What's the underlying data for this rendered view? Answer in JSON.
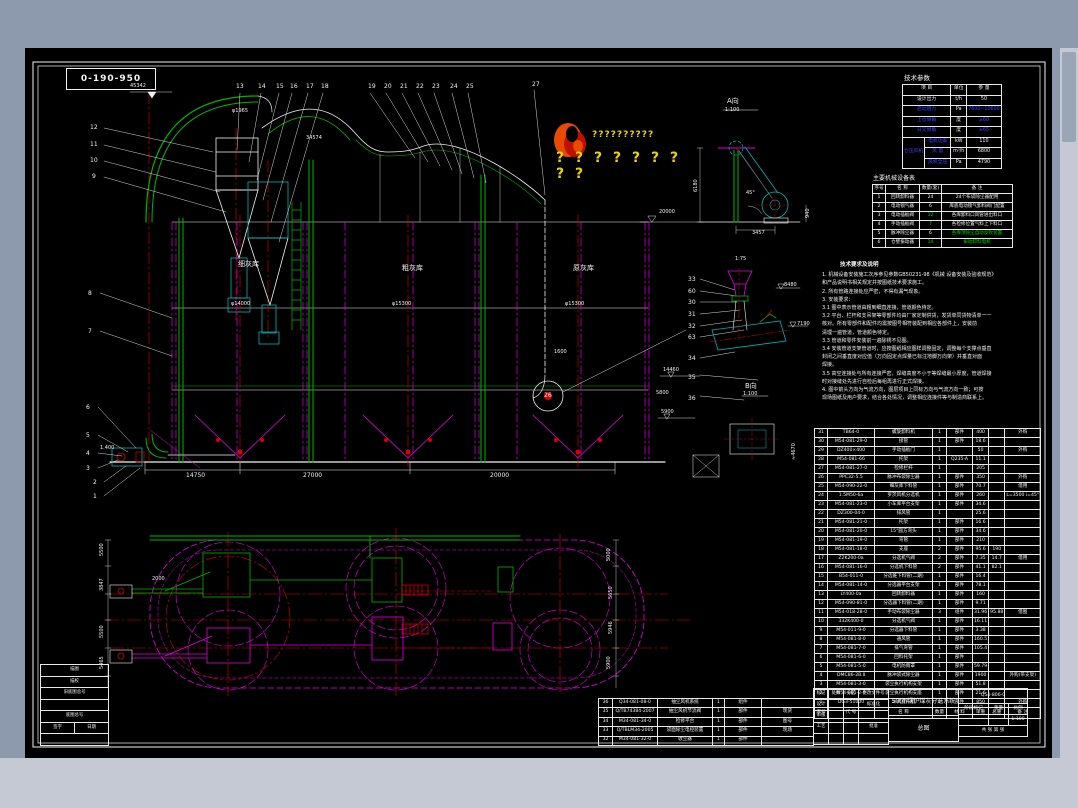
{
  "colors": {
    "window_top": "#8d9aad",
    "window_bottom": "#c4c9d3",
    "canvas": "#000000",
    "line": "#f2f2f2",
    "green": "#00b400",
    "magenta": "#e000e0",
    "red": "#dc0000",
    "cyan": "#00b4b4",
    "yellow": "#e8d400",
    "blue": "#3535ff"
  },
  "drawing_no_box": "0-190-950",
  "watermark": {
    "line1": "??????????",
    "line2": "···········",
    "line3": "? ? ? ? ? ? ? ? ?"
  },
  "tech_params": {
    "title": "技术参数",
    "headers": [
      "项  目",
      "单位",
      "参  量"
    ],
    "rows": [
      {
        "item": "设计出力",
        "unit": "t/h",
        "value": "50",
        "c": "w"
      },
      {
        "item": "启动阻力",
        "unit": "Pa",
        "value": "7600~10600",
        "c": "b"
      },
      {
        "item": "上仓倾角",
        "unit": "度",
        "value": "≥60",
        "c": "b"
      },
      {
        "item": "分叉倾角",
        "unit": "度",
        "value": "≥65",
        "c": "b"
      }
    ],
    "fan_group": {
      "label": "仓压风机",
      "rows": [
        {
          "item": "电机功率",
          "unit": "kW",
          "value": "110"
        },
        {
          "item": "风  量",
          "unit": "m³/h",
          "value": "6800"
        },
        {
          "item": "风机全压",
          "unit": "Pa",
          "value": "4790"
        }
      ]
    }
  },
  "equipment_table": {
    "title": "主要机械设备表",
    "headers": [
      "序号",
      "名  称",
      "数量(套)",
      "备    注"
    ],
    "rows": [
      [
        "1",
        "回转卸料器",
        "24",
        "24个布袋除尘器配用"
      ],
      [
        "2",
        "电动锁气器",
        "6",
        "库底电动锁气卸料阀门配置"
      ],
      [
        "3",
        "电动插板阀",
        {
          "t": "12",
          "c": "g"
        },
        "各库卸料口风管进出料口"
      ],
      [
        "4",
        "手动插板阀",
        {
          "t": "7",
          "c": "g"
        },
        "各检修位置气料上下料口"
      ],
      [
        "5",
        "脉冲除尘器",
        "6",
        {
          "t": "各库顶除尘自动反吹装置",
          "c": "g"
        }
      ],
      [
        "6",
        "仓壁振动器",
        {
          "t": "14",
          "c": "g"
        },
        {
          "t": "振动卸料电机",
          "c": "g"
        }
      ]
    ]
  },
  "notes": {
    "title": "技术要求及说明",
    "lines": [
      "1. 机械设备安装施工次序参见参数GB50231-98《机械 设备安装及验收规范》",
      "    和产品说明书相关规定并按图纸技术要求施工。",
      "2. 所有管路连接处应严密，不得有漏气现象。",
      "3. 安装要求：",
      "3.1 图中表示管道由粗到细直连接，管道颜色待定。",
      "3.2 平台、栏杆和支吊架等零部件均由厂家定制供货，发货单同货物清单一一",
      "    核对。所有零部件和配件均需按图号相符装配到相应各部件上，安装前",
      "    清理一遍管道，管道颜色待定。",
      "3.3 管道和零件安装前一遍除锈不见图。",
      "3.4 安装管道支架管道时，应按图纸相应图样调整固定，调整每个支撑点垂直",
      "    封闭之间垂直度对应值（万向固定点焊量已标注地脚万向架）并垂直对面",
      "    焊接。",
      "3.5 高空连接处与所有连接严密，焊缝高度不小于等焊缝最小厚度，管道焊接",
      "    时对接缝处先进行自检后每组再进行正式焊接。",
      "4. 图中箭头方向为气流方向，图层项目上同标方向与气流方向一致；可按",
      "    现场图纸及用户要求，结合各处情况，调整相应连接件等与制造商联系上。"
    ]
  },
  "bom_main": {
    "headers": [
      "序号",
      "代    号",
      "名    称",
      "数量",
      "材  料",
      "单重",
      "总重",
      "备 注"
    ],
    "rows": [
      [
        "31",
        "TB64-0",
        "螺旋卸料机",
        "1",
        "部件",
        "400",
        "",
        "外购"
      ],
      [
        "30",
        "M54-081-29-0",
        "接管",
        "1",
        "部件",
        "18.6",
        "",
        ""
      ],
      [
        "29",
        "DZ400×400",
        "手动插板门",
        "1",
        "",
        "50",
        "",
        "外购"
      ],
      [
        "28",
        "M54-081-66",
        "托架",
        "1",
        "Q235-A",
        "11.1",
        "",
        ""
      ],
      [
        "27",
        "M54-081-27-0",
        "检修栏杆",
        "1",
        "",
        "205",
        "",
        ""
      ],
      [
        "26",
        "PPC32-5.5",
        "脉冲布袋除尘器",
        "1",
        "部件",
        "350",
        "",
        "外购"
      ],
      [
        "25",
        "M54-090-22-0",
        "细灰库下料管",
        "1",
        "部件",
        "70.7",
        "",
        "借用"
      ],
      [
        "24",
        "1.5M50-6a",
        "罗茨风机分选机",
        "1",
        "部件",
        "260",
        "",
        "L=3500 i=45°"
      ],
      [
        "23",
        "M54-081-23-0",
        "小车库平台支架",
        "1",
        "部件",
        "34.6",
        "",
        ""
      ],
      [
        "22",
        "DZ300-04-0",
        "排风管",
        "1",
        "",
        "25.6",
        "",
        ""
      ],
      [
        "21",
        "M54-081-21-0",
        "托架",
        "1",
        "部件",
        "16.6",
        "",
        ""
      ],
      [
        "20",
        "M54-081-20-0",
        "15°圆方弯头",
        "1",
        "部件",
        "34.6",
        "",
        ""
      ],
      [
        "19",
        "M54-081-19-0",
        "弯管",
        "1",
        "部件",
        "210",
        "",
        ""
      ],
      [
        "18",
        "M54-081-18-0",
        "支座",
        "2",
        "部件",
        "95.6",
        "190",
        ""
      ],
      [
        "17",
        "Z2K200-0a",
        "分选机气阀",
        "2",
        "部件",
        "7.35",
        "14.7",
        "借用"
      ],
      [
        "16",
        "M54-081-16-0",
        "分选机下料管",
        "2",
        "部件",
        "41.1",
        "82.1",
        ""
      ],
      [
        "15",
        "B54-011-0",
        "分选锥下料管(二期)",
        "1",
        "部件",
        "16.4",
        "",
        ""
      ],
      [
        "14",
        "M54-081-14-0",
        "分选器平台支架",
        "1",
        "部件",
        "78.1",
        "",
        ""
      ],
      [
        "13",
        "LY400-0a",
        "回转卸料器",
        "1",
        "部件",
        "160",
        "",
        ""
      ],
      [
        "12",
        "M54-090-81-0",
        "分选器下料管(二期)",
        "1",
        "部件",
        "9.71",
        "",
        ""
      ],
      [
        "11",
        "M54-018-28-0",
        "手动布袋除尘器",
        "3",
        "组件",
        "31.96",
        "95.88",
        "借图"
      ],
      [
        "10",
        "332K400-0",
        "分选机气阀",
        "1",
        "部件",
        "16.11",
        "",
        ""
      ],
      [
        "9",
        "M54-011-9-0",
        "分选器下料管",
        "1",
        "部件",
        "3.38",
        "",
        ""
      ],
      [
        "8",
        "M54-081-8-0",
        "通风管",
        "1",
        "部件",
        "160.5",
        "",
        ""
      ],
      [
        "7",
        "M54-081-7-0",
        "排气弯管",
        "1",
        "部件",
        "105.4",
        "",
        ""
      ],
      [
        "6",
        "M54-081-6-0",
        "回料托架",
        "1",
        "部件",
        "",
        "",
        ""
      ],
      [
        "5",
        "M54-081-5-0",
        "电机防雨罩",
        "1",
        "部件",
        "59.79",
        "",
        ""
      ],
      [
        "4",
        "DMC86-2B.Ⅱ",
        "脉冲袋式除尘器",
        "1",
        "部件",
        "1900",
        "",
        "外购(带支架)"
      ],
      [
        "3",
        "M54-081-3-0",
        "袋尘执行机构支架",
        "1",
        "部件",
        "51.8",
        "",
        ""
      ],
      [
        "2",
        "M54-081-2-0",
        "袋尘执行机构支座",
        "1",
        "部件",
        "21.6",
        "",
        ""
      ],
      [
        "1",
        "DG3-51000",
        "斗式提升机",
        "1",
        "部件",
        "850",
        "",
        "外购"
      ]
    ]
  },
  "bom_extra": {
    "rows": [
      [
        "36",
        "Q34-081-08-0",
        "抽尘风机系统",
        "1",
        "组件",
        ""
      ],
      [
        "35",
        "Q/TB74384-2007",
        "抽尘风机节流阀",
        "1",
        "部件",
        "现货"
      ],
      [
        "34",
        "M34-081-34-0",
        "检修平台",
        "1",
        "部件",
        "图号"
      ],
      [
        "33",
        "Q/TBLM34-2005",
        "袋面除尘电控装置",
        "1",
        "部件",
        "现场"
      ],
      [
        "32",
        "M34-081-32-0",
        "收尘器",
        "1",
        "部件",
        ""
      ]
    ]
  },
  "title_block": {
    "title": "50t/h锅炉煤灰分选系统",
    "subtitle": "总图",
    "drawing_number": "Q54-806-0",
    "scale": "1:100",
    "stage_label": "阶段标记",
    "weight_label": "重量",
    "scale_label": "比例",
    "sheet": "共  张  第  张",
    "left_rows": [
      [
        "标记",
        "处数",
        "分区",
        "更改文件号"
      ],
      [
        "设计",
        "",
        "",
        "标准化"
      ],
      [
        "审核",
        "",
        "",
        ""
      ],
      [
        "工艺",
        "",
        "",
        "批准"
      ],
      [
        "",
        "",
        "",
        ""
      ]
    ]
  },
  "archive_block": {
    "rows": [
      [
        "描图"
      ],
      [
        "描校"
      ],
      [
        "旧底图总号"
      ],
      [
        ""
      ],
      [
        "底图总号"
      ],
      [
        "签字",
        "日期"
      ],
      [
        ""
      ]
    ]
  },
  "silos": [
    "细灰库",
    "粗灰库",
    "原灰库"
  ],
  "labels": [
    {
      "t": "45342",
      "x": 130,
      "y": 84,
      "s": 5
    },
    {
      "t": "φ1965",
      "x": 232,
      "y": 109,
      "s": 5
    },
    {
      "t": "34574",
      "x": 306,
      "y": 136,
      "s": 5
    },
    {
      "t": "13",
      "x": 236,
      "y": 84
    },
    {
      "t": "14",
      "x": 258,
      "y": 84
    },
    {
      "t": "15",
      "x": 276,
      "y": 84
    },
    {
      "t": "16",
      "x": 290,
      "y": 84
    },
    {
      "t": "17",
      "x": 306,
      "y": 84
    },
    {
      "t": "18",
      "x": 321,
      "y": 84
    },
    {
      "t": "19",
      "x": 368,
      "y": 84
    },
    {
      "t": "20",
      "x": 384,
      "y": 84
    },
    {
      "t": "21",
      "x": 400,
      "y": 84
    },
    {
      "t": "22",
      "x": 416,
      "y": 84
    },
    {
      "t": "23",
      "x": 432,
      "y": 84
    },
    {
      "t": "24",
      "x": 450,
      "y": 84
    },
    {
      "t": "25",
      "x": 466,
      "y": 84
    },
    {
      "t": "27",
      "x": 532,
      "y": 82
    },
    {
      "t": "12",
      "x": 90,
      "y": 125
    },
    {
      "t": "11",
      "x": 90,
      "y": 142
    },
    {
      "t": "10",
      "x": 90,
      "y": 158
    },
    {
      "t": "9",
      "x": 92,
      "y": 174
    },
    {
      "t": "8",
      "x": 88,
      "y": 291
    },
    {
      "t": "7",
      "x": 88,
      "y": 329
    },
    {
      "t": "6",
      "x": 86,
      "y": 405
    },
    {
      "t": "5",
      "x": 86,
      "y": 433
    },
    {
      "t": "4",
      "x": 86,
      "y": 451
    },
    {
      "t": "3",
      "x": 86,
      "y": 466
    },
    {
      "t": "2",
      "x": 93,
      "y": 480
    },
    {
      "t": "1",
      "x": 93,
      "y": 494
    },
    {
      "t": "1.400",
      "x": 100,
      "y": 446,
      "s": 5
    },
    {
      "t": "细灰库",
      "x": 238,
      "y": 261,
      "s": 7
    },
    {
      "t": "粗灰库",
      "x": 402,
      "y": 265,
      "s": 7
    },
    {
      "t": "原灰库",
      "x": 573,
      "y": 265,
      "s": 7
    },
    {
      "t": "φ14000",
      "x": 231,
      "y": 302,
      "s": 5
    },
    {
      "t": "φ15300",
      "x": 392,
      "y": 302,
      "s": 5
    },
    {
      "t": "φ15300",
      "x": 565,
      "y": 302,
      "s": 5
    },
    {
      "t": "20000",
      "x": 659,
      "y": 210,
      "s": 5
    },
    {
      "t": "5800",
      "x": 656,
      "y": 391,
      "s": 5
    },
    {
      "t": "1600",
      "x": 554,
      "y": 350,
      "s": 5
    },
    {
      "t": "26",
      "x": 544,
      "y": 393,
      "s": 6
    },
    {
      "t": "14750",
      "x": 186,
      "y": 473
    },
    {
      "t": "27000",
      "x": 303,
      "y": 473
    },
    {
      "t": "20000",
      "x": 490,
      "y": 473
    },
    {
      "t": "A向",
      "x": 727,
      "y": 98,
      "s": 7
    },
    {
      "t": "1:100",
      "x": 725,
      "y": 108,
      "s": 5
    },
    {
      "t": "6180",
      "x": 694,
      "y": 192,
      "s": 5,
      "r": -90
    },
    {
      "t": "45°",
      "x": 746,
      "y": 191,
      "s": 5
    },
    {
      "t": "3457",
      "x": 752,
      "y": 231,
      "s": 5
    },
    {
      "t": "940",
      "x": 806,
      "y": 218,
      "s": 5,
      "r": -90
    },
    {
      "t": "1:75",
      "x": 735,
      "y": 257,
      "s": 5
    },
    {
      "t": "33",
      "x": 688,
      "y": 277
    },
    {
      "t": "60",
      "x": 688,
      "y": 289
    },
    {
      "t": "30",
      "x": 688,
      "y": 300
    },
    {
      "t": "31",
      "x": 688,
      "y": 312
    },
    {
      "t": "32",
      "x": 688,
      "y": 324
    },
    {
      "t": "63",
      "x": 688,
      "y": 335
    },
    {
      "t": "34",
      "x": 688,
      "y": 356
    },
    {
      "t": "35",
      "x": 688,
      "y": 375
    },
    {
      "t": "36",
      "x": 688,
      "y": 396
    },
    {
      "t": "8480",
      "x": 784,
      "y": 283,
      "s": 5
    },
    {
      "t": "7190",
      "x": 797,
      "y": 322,
      "s": 5
    },
    {
      "t": "14460",
      "x": 663,
      "y": 368,
      "s": 5
    },
    {
      "t": "5900",
      "x": 661,
      "y": 410,
      "s": 5
    },
    {
      "t": "B向",
      "x": 745,
      "y": 383,
      "s": 7
    },
    {
      "t": "1:100",
      "x": 743,
      "y": 392,
      "s": 5
    },
    {
      "t": "≈4670",
      "x": 792,
      "y": 460,
      "s": 5,
      "r": -90
    },
    {
      "t": "5500",
      "x": 100,
      "y": 556,
      "s": 5,
      "r": -90
    },
    {
      "t": "3847",
      "x": 100,
      "y": 591,
      "s": 5,
      "r": -90
    },
    {
      "t": "5500",
      "x": 100,
      "y": 638,
      "s": 5,
      "r": -90
    },
    {
      "t": "5465",
      "x": 100,
      "y": 669,
      "s": 5,
      "r": -90
    },
    {
      "t": "5000",
      "x": 607,
      "y": 561,
      "s": 5,
      "r": -90
    },
    {
      "t": "5650",
      "x": 609,
      "y": 599,
      "s": 5,
      "r": -90
    },
    {
      "t": "5946",
      "x": 609,
      "y": 634,
      "s": 5,
      "r": -90
    },
    {
      "t": "5900",
      "x": 607,
      "y": 669,
      "s": 5,
      "r": -90
    },
    {
      "t": "2000",
      "x": 152,
      "y": 577,
      "s": 5
    }
  ]
}
